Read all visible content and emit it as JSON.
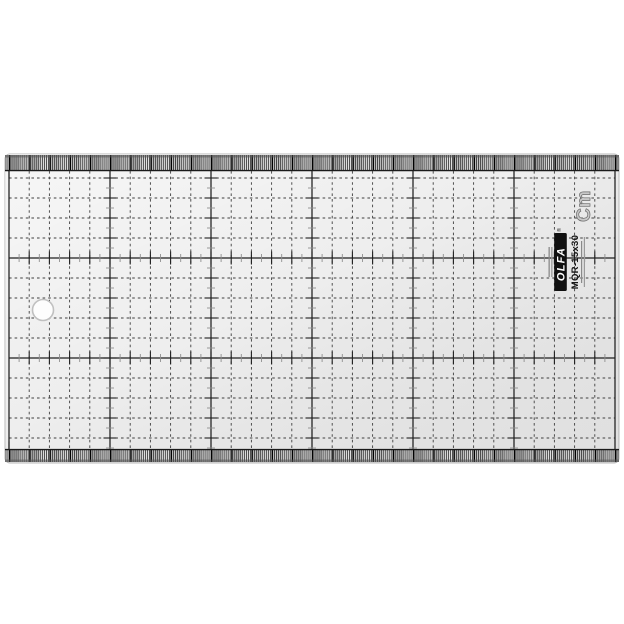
{
  "colors": {
    "ink": "#1f1f1f",
    "grid": "#3f3f3f",
    "tick_gray": "#8f8f8f",
    "body": "#ececec",
    "strip_bg": "#e8e8e8",
    "badge_fill": "#ffffff",
    "unit_fill": "#c8c8c8",
    "unit_stroke": "#6a6a6a",
    "logo_bg": "#101010",
    "logo_text": "#ffffff",
    "hole_fill": "#fdfdfd",
    "hole_rim": "#c0c0c0"
  },
  "scales": {
    "unit": "Cm",
    "top": [
      "5",
      "10",
      "15",
      "20",
      "25"
    ],
    "bottom": [
      "5",
      "10",
      "15",
      "20",
      "25"
    ],
    "left": [
      "10",
      "5"
    ],
    "right": [
      "10",
      "5"
    ]
  },
  "protractor": {
    "badges": [
      {
        "label": "15°",
        "deg": 15,
        "side": "left"
      },
      {
        "label": "30°",
        "deg": 30,
        "side": "left"
      },
      {
        "label": "45°",
        "deg": 45,
        "side": "left"
      },
      {
        "label": "60°",
        "deg": 60,
        "side": "left"
      },
      {
        "label": "90°",
        "deg": 90,
        "side": "center"
      },
      {
        "label": "60°",
        "deg": 60,
        "side": "right"
      },
      {
        "label": "45°",
        "deg": 45,
        "side": "right"
      },
      {
        "label": "30°",
        "deg": 30,
        "side": "right"
      },
      {
        "label": "15°",
        "deg": 15,
        "side": "right"
      }
    ]
  },
  "brand": {
    "name": "OLFA",
    "registered": "®",
    "model": "MQR-15x30"
  }
}
